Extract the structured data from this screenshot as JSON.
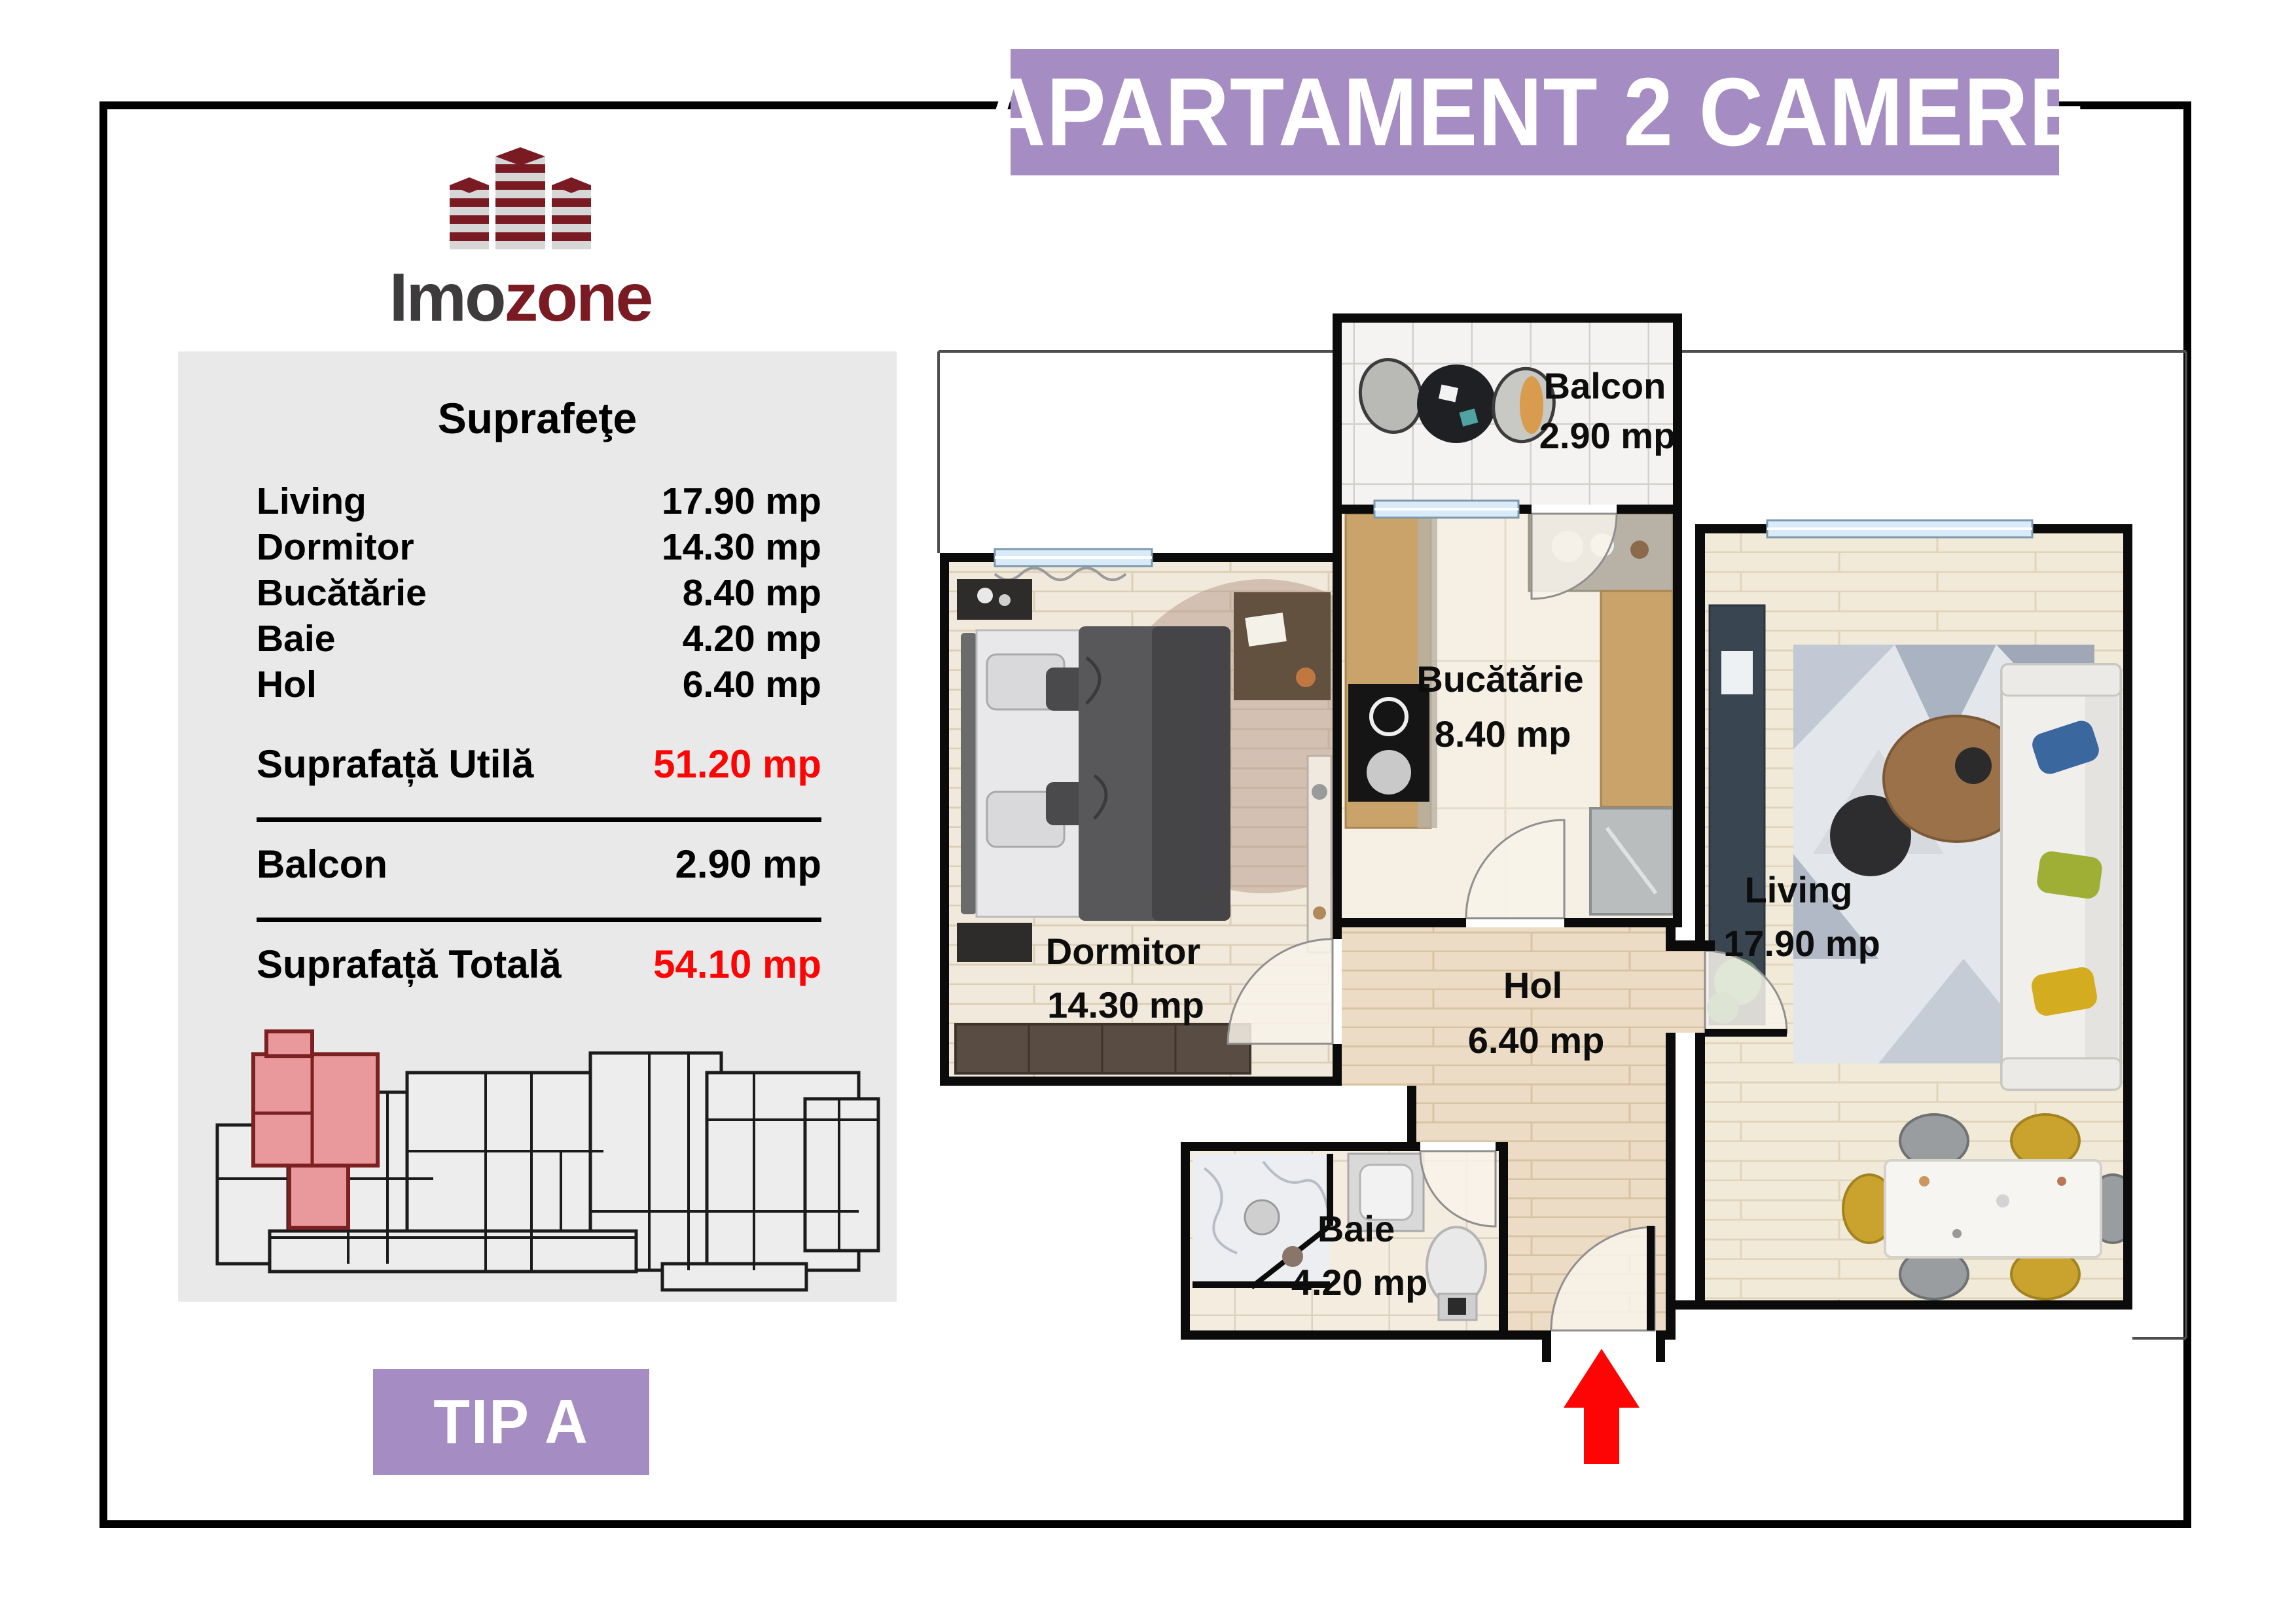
{
  "header": {
    "title": "APARTAMENT 2 CAMERE",
    "accent_color": "#a58dc3"
  },
  "logo": {
    "brand_gray": "Imo",
    "brand_red": "zone",
    "brick_red": "#7a1b24",
    "brick_gray": "#d6d6d6"
  },
  "panel": {
    "title": "Suprafeţe",
    "rows": [
      {
        "label": "Living",
        "value": "17.90 mp"
      },
      {
        "label": "Dormitor",
        "value": "14.30 mp"
      },
      {
        "label": "Bucătărie",
        "value": "8.40 mp"
      },
      {
        "label": "Baie",
        "value": "4.20 mp"
      },
      {
        "label": "Hol",
        "value": "6.40 mp"
      }
    ],
    "summary": [
      {
        "label": "Suprafață Utilă",
        "value": "51.20 mp"
      },
      {
        "label": "Balcon",
        "value": "2.90 mp"
      },
      {
        "label": "Suprafață Totală",
        "value": "54.10 mp"
      }
    ],
    "highlight_color": "#fb0505",
    "miniplan_highlight_color": "#e9999b"
  },
  "type_badge": {
    "label": "TIP A"
  },
  "floorplan": {
    "rooms": [
      {
        "name": "Balcon",
        "area": "2.90 mp"
      },
      {
        "name": "Bucătărie",
        "area": "8.40 mp"
      },
      {
        "name": "Dormitor",
        "area": "14.30 mp"
      },
      {
        "name": "Living",
        "area": "17.90 mp"
      },
      {
        "name": "Hol",
        "area": "6.40 mp"
      },
      {
        "name": "Baie",
        "area": "4.20 mp"
      }
    ],
    "entrance_arrow_color": "#fe0505"
  }
}
